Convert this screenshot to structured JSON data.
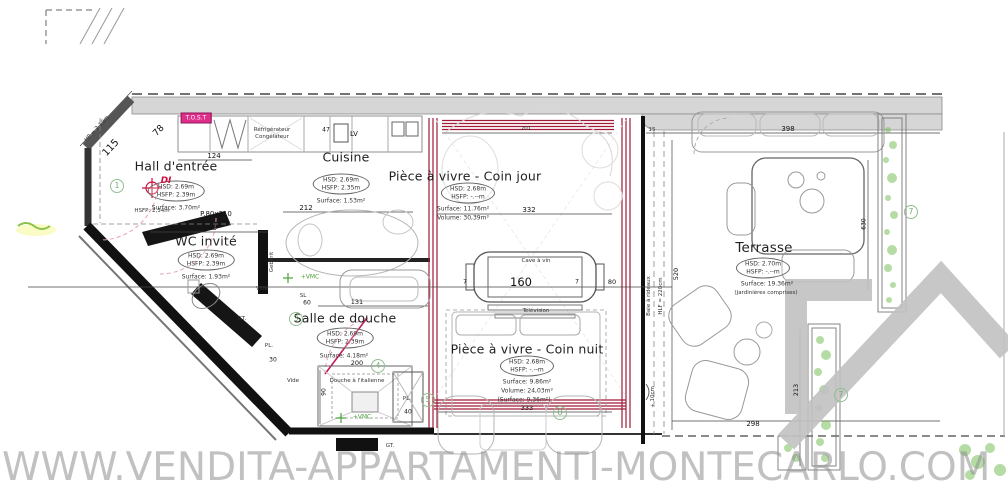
{
  "watermark": {
    "text": "WWW.VENDITA-APPARTAMENTI-MONTECARLO.COM"
  },
  "rooms": {
    "hall": {
      "title": "Hall d'entrée",
      "hsd": "HSD: 2.69m",
      "hsfp": "HSFP: 2.39m",
      "surface": "Surface: 3.70m²",
      "door": "P.80x210"
    },
    "cuisine": {
      "title": "Cuisine",
      "hsd": "HSD: 2.69m",
      "hsfp": "HSFP: 2.35m",
      "surface": "Surface: 1.53m²"
    },
    "coin_jour": {
      "title": "Pièce à vivre - Coin jour",
      "hsd": "HSD: 2.68m",
      "hsfp": "HSFP: -.--m",
      "surface": "Surface: 11.76m²",
      "volume": "Volume: 30,39m³"
    },
    "wc": {
      "title": "WC invité",
      "hsd": "HSD: 2.69m",
      "hsfp": "HSFP: 2.39m",
      "surface": "Surface: 1.93m²"
    },
    "douche": {
      "title": "Salle de douche",
      "hsd": "HSD: 2.69m",
      "hsfp": "HSFP: 2.39m",
      "surface": "Surface: 4.18m²"
    },
    "coin_nuit": {
      "title": "Pièce à vivre - Coin nuit",
      "hsd": "HSD: 2.68m",
      "hsfp": "HSFP: -.--m",
      "surface": "Surface: 9.86m²",
      "volume": "Volume: 24,03m³",
      "surface2": "(Surface: 9,36m²)"
    },
    "terrasse": {
      "title": "Terrasse",
      "hsd": "HSD: 2.70m",
      "hsfp": "HSFP: -.--m",
      "surface": "Surface: 19.36m²",
      "note": "(Jardinières comprises)"
    }
  },
  "annotations": {
    "refrigerateur": "Réfrigérateur",
    "congelateur": "Congélateur",
    "lv": "LV",
    "cave_a_vin": "Cave à vin",
    "television": "Télévision",
    "douche_italienne": "Douche à l'italienne",
    "geberit": "Gebérit",
    "vide": "Vide",
    "gt": "GT.",
    "pl": "PL.",
    "sl": "SL",
    "vmc": "+VMC",
    "baie": "Baie à rideaux",
    "hlf": "HLF = 220cm",
    "hp": "HP = 2.19m",
    "hsfp_entree": "HSFP: 2,34m",
    "plus10": "+ 10cm",
    "di": "DI",
    "badge": "T.O.S.T"
  },
  "dims": {
    "d115": "115",
    "d78": "78",
    "d124": "124",
    "d47": "47",
    "d238": "238",
    "d212": "212",
    "d201": "201",
    "d332": "332",
    "d15": "15",
    "d398": "398",
    "d160": "160",
    "d7a": "7",
    "d7b": "7",
    "d80": "80",
    "d131": "131",
    "d60": "60",
    "d30": "30",
    "d200": "200",
    "d90": "90",
    "d40": "40",
    "d333": "333",
    "d298": "298",
    "d520": "520",
    "d630": "630",
    "d213": "213"
  },
  "refs": {
    "r1": "1",
    "r3": "3",
    "r4": "4",
    "r5": "5",
    "r7": "7",
    "r8": "8"
  },
  "colors": {
    "window_red": "#a01a38",
    "marker_pink": "#df2d8a",
    "plant_green": "#7cc05e",
    "ref_green": "#6fae6f",
    "wall_gray": "#d6d6d6",
    "watermark_gray": "#8f8f8f"
  }
}
